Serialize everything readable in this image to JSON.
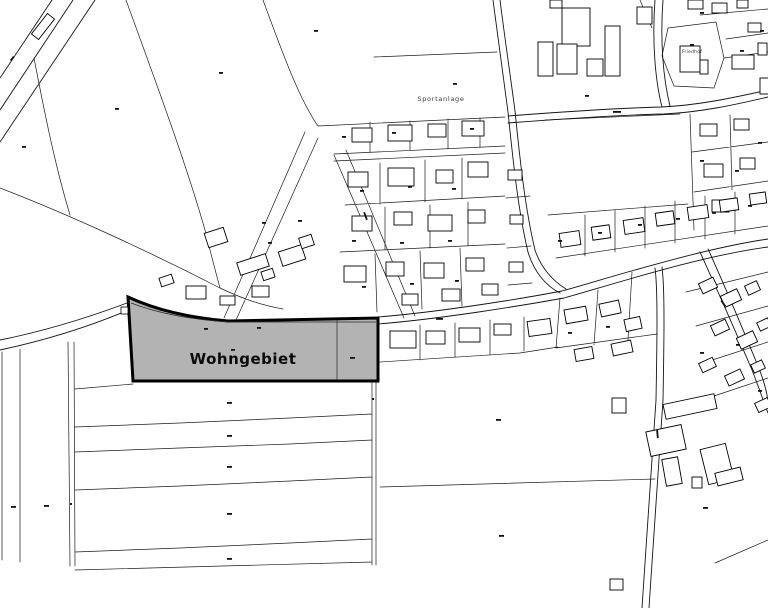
{
  "map": {
    "kind": "cadastral-site-plan",
    "background": "#ffffff",
    "line_color": "#1c1c1c",
    "labels": {
      "wohngebiet": "Wohngebiet",
      "sportanlage": "Sportanlage",
      "friedhof": "Friedhof"
    },
    "highlight_area": {
      "name": "Wohngebiet",
      "fill": "#b3b3b3",
      "border": "#000000"
    }
  }
}
